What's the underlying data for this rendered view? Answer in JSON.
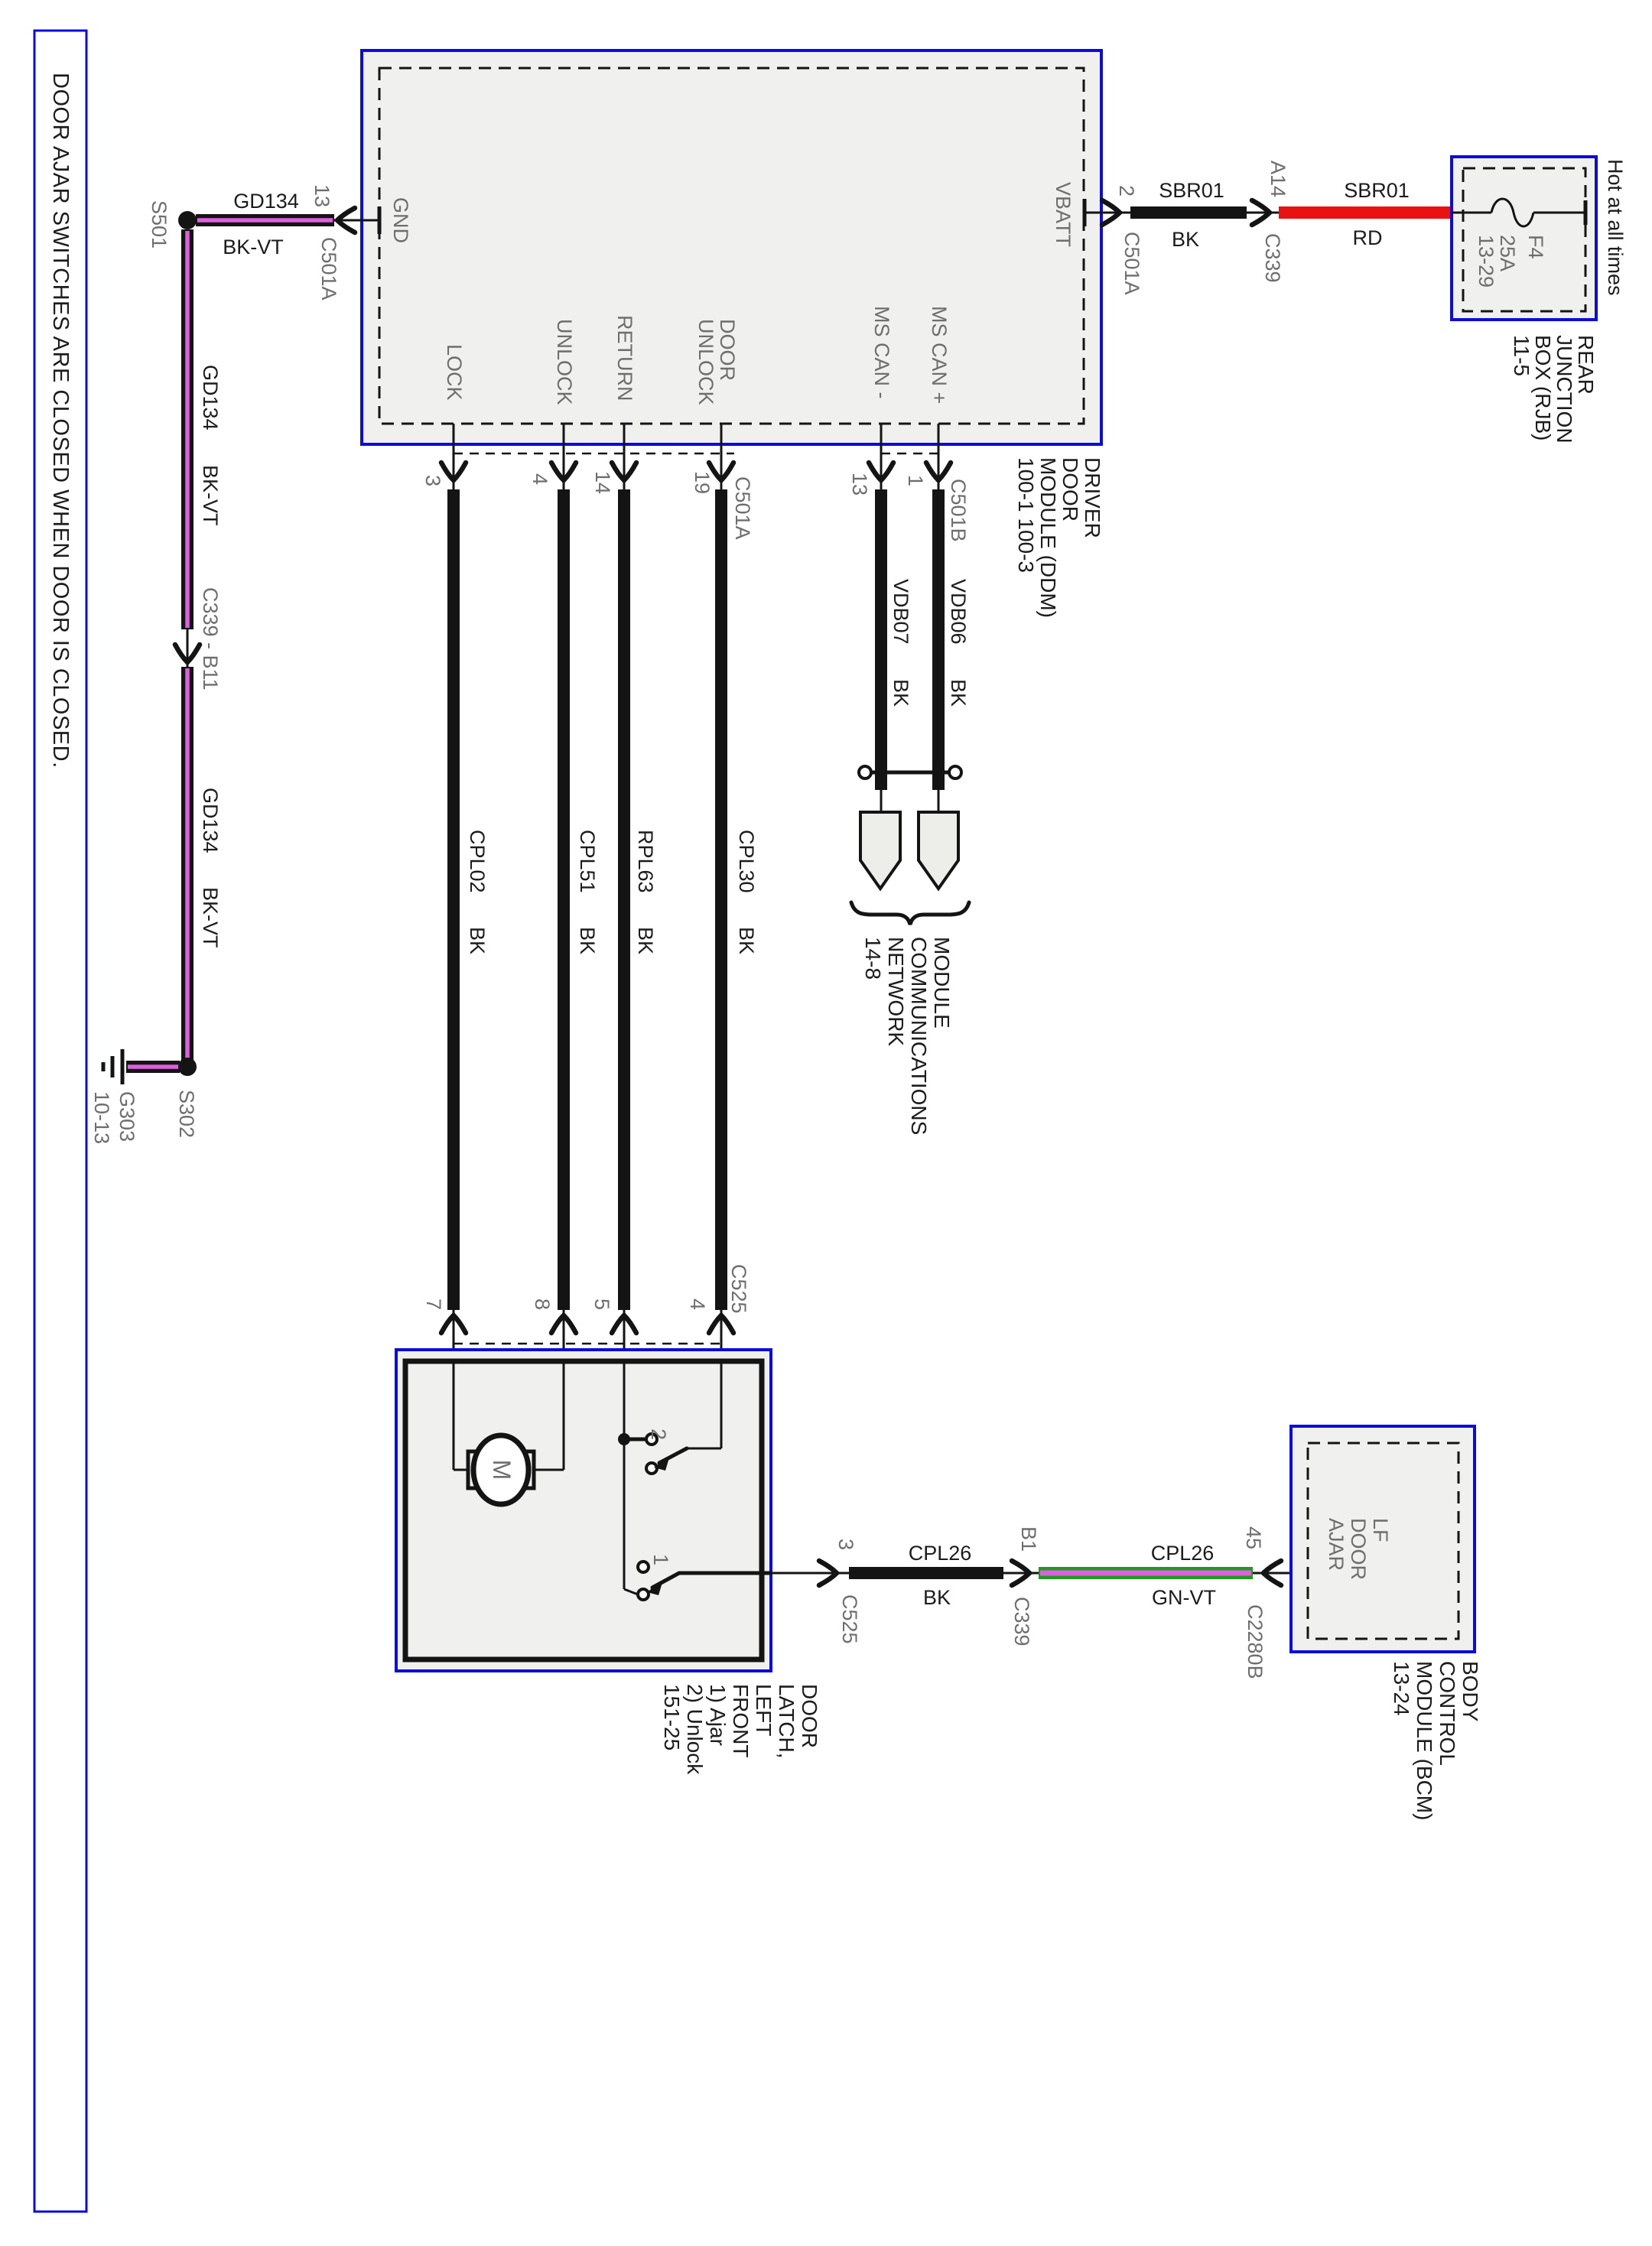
{
  "colors": {
    "blue": "#0b0bdf",
    "red": "#e81212",
    "green": "#1f9a1f",
    "violet": "#df60df",
    "wire_black": "#141414",
    "ink": "#1c1c1c",
    "label_gray": "#6e6e6e",
    "box_fill": "#f0f0ee"
  },
  "note": {
    "text": "DOOR AJAR SWITCHES ARE CLOSED WHEN DOOR IS CLOSED."
  },
  "ddm": {
    "caption": [
      "DRIVER",
      "DOOR",
      "MODULE (DDM)",
      "100-1  100-3"
    ],
    "gnd": "GND",
    "vbatt": "VBATT",
    "lock": "LOCK",
    "unlock": "UNLOCK",
    "ret": "RETURN",
    "door": "DOOR",
    "door_unlock": "UNLOCK",
    "can_minus": "MS CAN -",
    "can_plus": "MS CAN +"
  },
  "gnd_branch": {
    "splice": "S501",
    "wire": "GD134",
    "color": "BK-VT",
    "pin": "13",
    "conn": "C501A"
  },
  "left_drop": {
    "wire1": "GD134",
    "color1": "BK-VT",
    "conn": "C339 - B11",
    "wire2": "GD134",
    "color2": "BK-VT",
    "splice": "S302",
    "ground": "G303",
    "ground_ref": "10-13"
  },
  "vbatt_branch": {
    "pin": "2",
    "conn": "C501A",
    "wire1": "SBR01",
    "color1": "BK",
    "pin2": "A14",
    "conn2": "C339",
    "wire2": "SBR01",
    "color2": "RD"
  },
  "rjb": {
    "hot": "Hot at all times",
    "fuse": [
      "F4",
      "25A",
      "13-29"
    ],
    "caption": [
      "REAR",
      "JUNCTION",
      "BOX (RJB)",
      "11-5"
    ]
  },
  "power": {
    "pins_top": [
      "3",
      "4",
      "14",
      "19"
    ],
    "conn_top": "C501A",
    "w1": "CPL02",
    "w1c": "BK",
    "w2": "CPL51",
    "w2c": "BK",
    "w3": "RPL63",
    "w3c": "BK",
    "w4": "CPL30",
    "w4c": "BK",
    "pins_bottom": [
      "7",
      "8",
      "5",
      "4"
    ],
    "conn_bottom": "C525"
  },
  "can": {
    "pin_minus": "13",
    "pin_plus": "1",
    "conn": "C501B",
    "w1": "VDB07",
    "w1c": "BK",
    "w2": "VDB06",
    "w2c": "BK",
    "caption": [
      "MODULE",
      "COMMUNICATIONS",
      "NETWORK",
      "14-8"
    ]
  },
  "latch": {
    "motor": "M",
    "sw2": "2",
    "sw1": "1",
    "caption": [
      "DOOR",
      "LATCH,",
      "LEFT",
      "FRONT",
      "1) Ajar",
      "2) Unlock",
      "151-25"
    ]
  },
  "out": {
    "pin1": "3",
    "conn1": "C525",
    "wire1": "CPL26",
    "color1": "BK",
    "pin2": "B1",
    "conn2": "C339",
    "wire2": "CPL26",
    "color2": "GN-VT",
    "pin3": "45",
    "conn3": "C2280B"
  },
  "bcm": {
    "terminal": [
      "LF",
      "DOOR",
      "AJAR"
    ],
    "caption": [
      "BODY",
      "CONTROL",
      "MODULE (BCM)",
      "13-24"
    ]
  }
}
